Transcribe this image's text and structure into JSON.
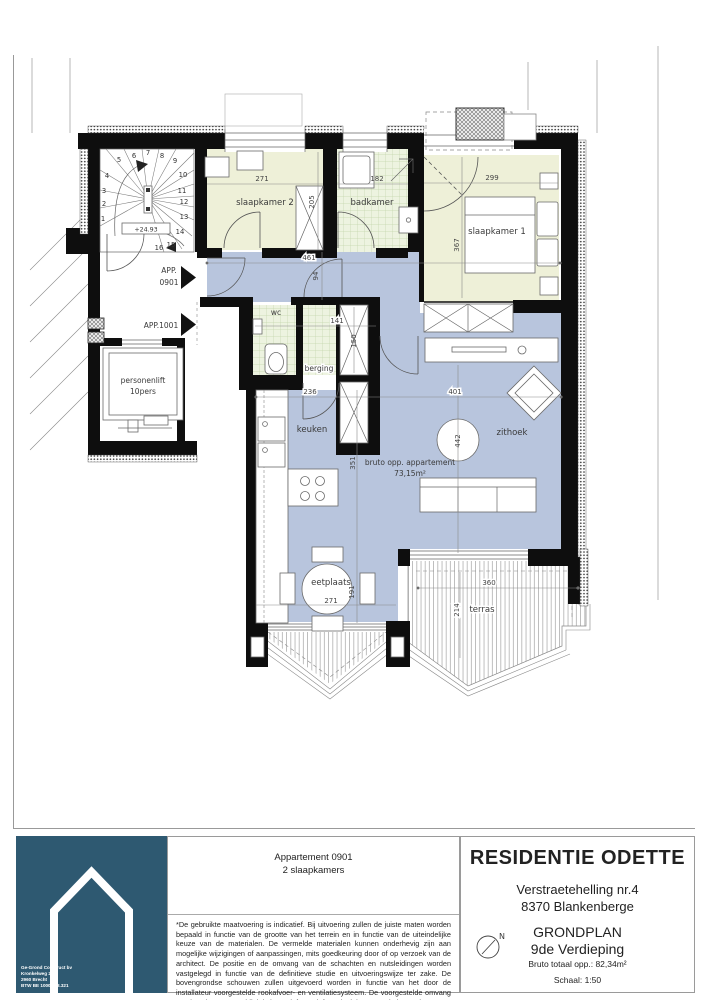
{
  "plan": {
    "colors": {
      "living": "#b8c5dd",
      "bedroom": "#eef0d8",
      "tile": "#edf3e0",
      "wall": "#0e0e0e"
    },
    "rooms": {
      "slaapkamer2": "slaapkamer 2",
      "badkamer": "badkamer",
      "slaapkamer1": "slaapkamer 1",
      "wc": "wc",
      "berging": "berging",
      "keuken": "keuken",
      "zithoek": "zithoek",
      "eetplaats": "eetplaats",
      "terras": "terras",
      "lift_line1": "personenlift",
      "lift_line2": "10pers"
    },
    "labels": {
      "app0901_line1": "APP.",
      "app0901_line2": "0901",
      "app1001": "APP.1001",
      "level": "+24.93",
      "area_line1": "bruto opp. appartement",
      "area_line2": "73,15m²"
    },
    "dims": {
      "sk2_w": "271",
      "sk2_d": "205",
      "bad_w": "182",
      "sk1_w": "299",
      "sk1_d": "367",
      "hal_w": "461",
      "hal_d": "94",
      "wc_w": "141",
      "shaft_d": "150",
      "keuken_w": "236",
      "living_w": "401",
      "living_d2": "442",
      "living_d": "351",
      "eet_w": "271",
      "eet_d": "191",
      "terras_w": "360",
      "terras_d": "214"
    },
    "stair_numbers": [
      "1",
      "2",
      "3",
      "4",
      "5",
      "6",
      "7",
      "8",
      "9",
      "10",
      "11",
      "12",
      "13",
      "14",
      "15",
      "16"
    ]
  },
  "titleblock": {
    "logo": {
      "company": "Ge-Grond Construct bv",
      "address": "Kronkelweg 2b",
      "city": "2960 Brecht",
      "vat": "BTW BE 1000.008.321"
    },
    "apartment_line1": "Appartement 0901",
    "apartment_line2": "2 slaapkamers",
    "disclaimer": "*De gebruikte maatvoering is indicatief. Bij uitvoering zullen de juiste maten worden bepaald in functie van de grootte van het terrein en in functie van de uiteindelijke keuze van de materialen. De vermelde materialen kunnen onderhevig zijn aan mogelijke wijzigingen of aanpassingen, mits goedkeuring door of op verzoek van de architect. De positie en de omvang van de schachten en nutsleidingen worden vastgelegd in functie van de definitieve studie en uitvoeringswijze ter zake. De bovengrondse schouwen zullen uitgevoerd worden in functie van het door de installateur voorgestelde rookafvoer- en ventilatiesysteem. De voorgestelde omvang en plaatsing van meubilair is louter informatief en niet inbegrepen in het project.",
    "project_name": "RESIDENTIE ODETTE",
    "address_line1": "Verstraetehelling nr.4",
    "address_line2": "8370 Blankenberge",
    "plan_type": "GRONDPLAN",
    "floor": "9de Verdieping",
    "area_total": "Bruto totaal opp.: 82,34m²",
    "scale": "Schaal: 1:50",
    "north_label": "N"
  }
}
